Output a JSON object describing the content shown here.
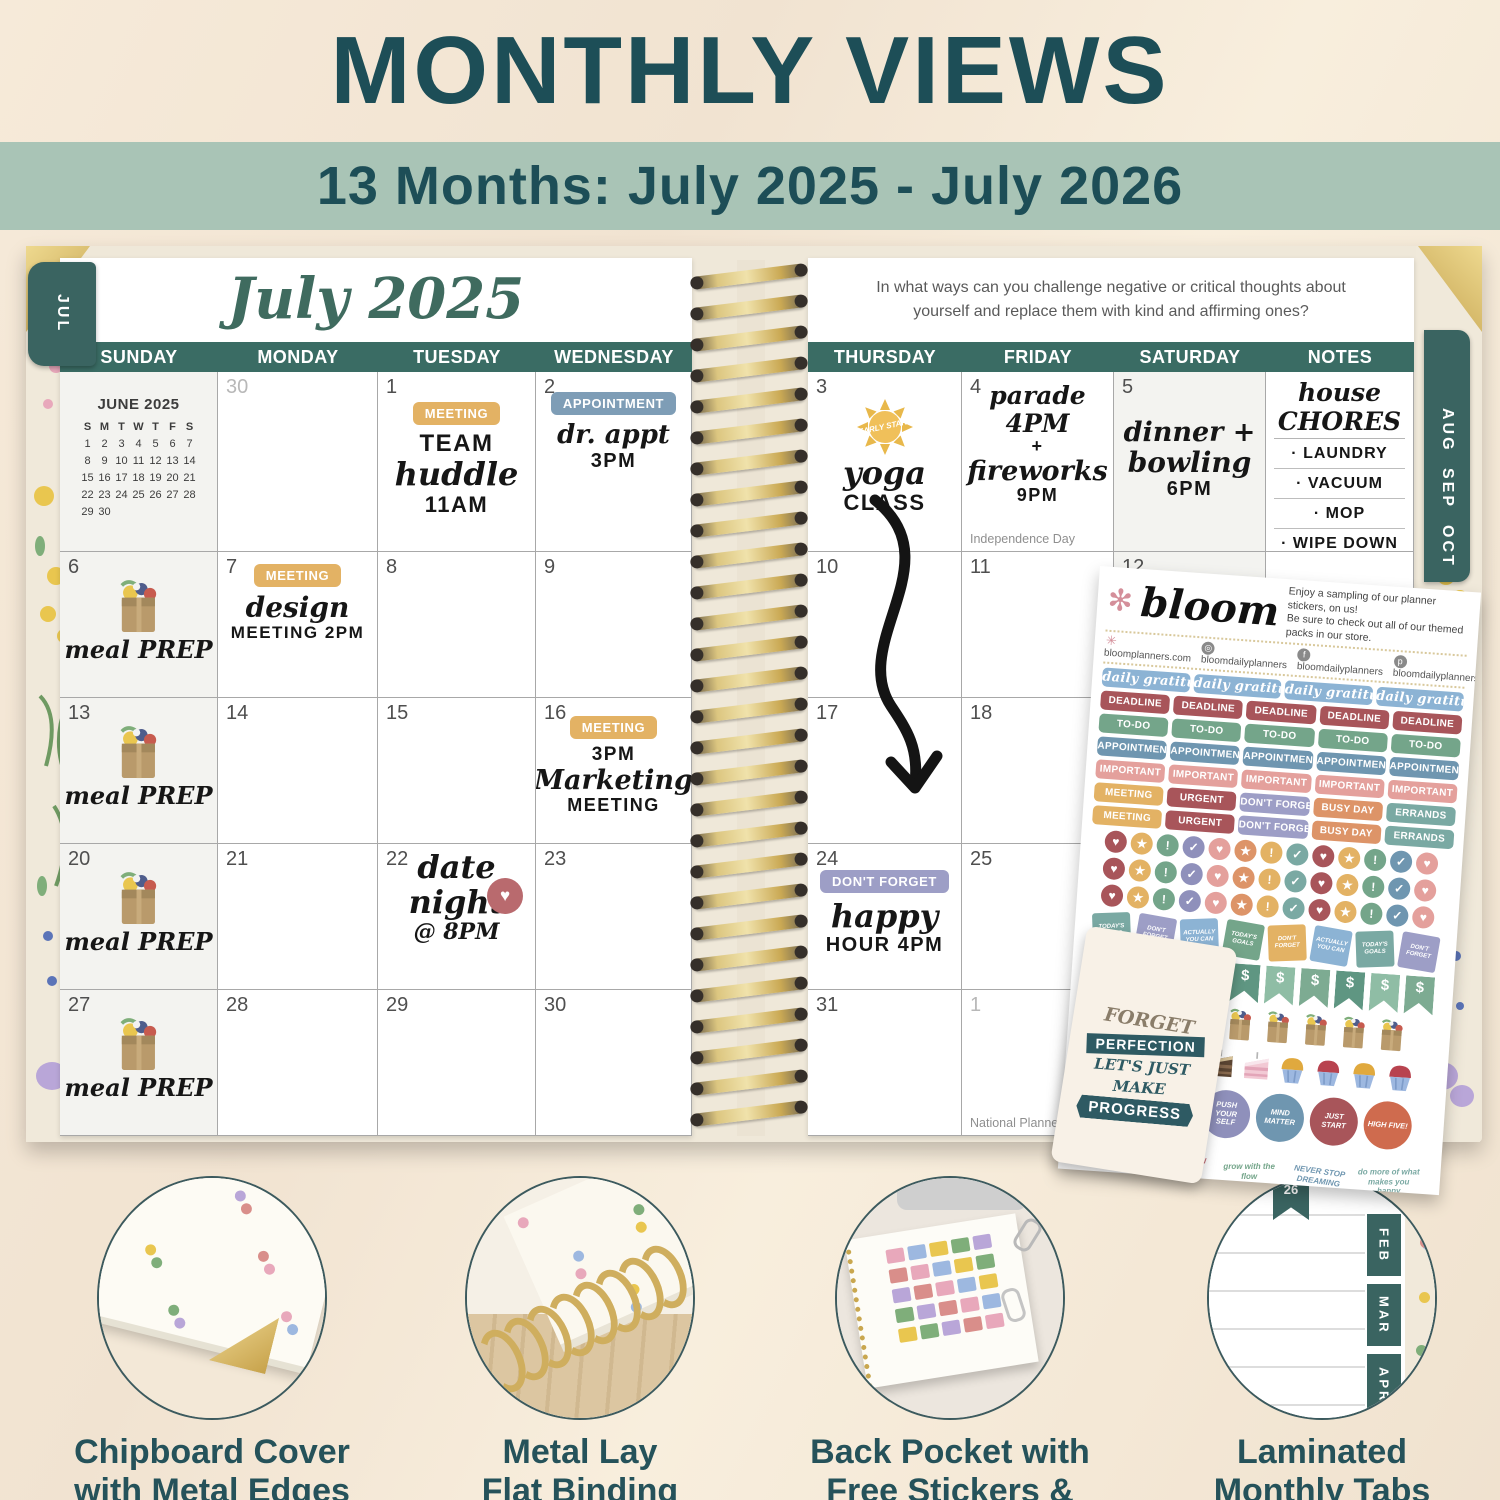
{
  "palette": {
    "title_teal": "#1d4e57",
    "band_sage": "#a9c4b6",
    "calendar_header_teal": "#3a6c64",
    "tab_teal": "#3a6461",
    "gold": "#d6b96a",
    "page_white": "#ffffff"
  },
  "header": {
    "title": "MONTHLY VIEWS",
    "subtitle": "13 Months: July 2025 - July 2026"
  },
  "left_page": {
    "tab": "JUL",
    "month_title": "July 2025",
    "day_headers": [
      "SUNDAY",
      "MONDAY",
      "TUESDAY",
      "WEDNESDAY"
    ],
    "mini_calendar": {
      "title": "JUNE 2025",
      "dow": [
        "S",
        "M",
        "T",
        "W",
        "T",
        "F",
        "S"
      ],
      "weeks": [
        [
          "1",
          "2",
          "3",
          "4",
          "5",
          "6",
          "7"
        ],
        [
          "8",
          "9",
          "10",
          "11",
          "12",
          "13",
          "14"
        ],
        [
          "15",
          "16",
          "17",
          "18",
          "19",
          "20",
          "21"
        ],
        [
          "22",
          "23",
          "24",
          "25",
          "26",
          "27",
          "28"
        ],
        [
          "29",
          "30",
          "",
          "",
          "",
          "",
          ""
        ]
      ]
    },
    "rows": [
      {
        "cells": [
          {
            "type": "minical"
          },
          {
            "day": "30",
            "muted": true
          },
          {
            "day": "1",
            "sticker": {
              "label": "MEETING",
              "color": "#e3b264"
            },
            "hand": [
              {
                "t": "TEAM",
                "s": "hc",
                "z": 24
              },
              {
                "t": "huddle",
                "s": "hs",
                "z": 32
              },
              {
                "t": "11AM",
                "s": "hc",
                "z": 22
              }
            ]
          },
          {
            "day": "2",
            "gap": 16,
            "sticker": {
              "label": "APPOINTMENT",
              "color": "#7e9db6"
            },
            "hand": [
              {
                "t": "dr. appt",
                "s": "hs",
                "z": 26
              },
              {
                "t": "3PM",
                "s": "hc",
                "z": 20
              }
            ]
          }
        ]
      },
      {
        "cells": [
          {
            "day": "6",
            "icon": "bag",
            "hand": [
              {
                "t": "meal PREP",
                "s": "hs",
                "z": 24
              }
            ]
          },
          {
            "day": "7",
            "gap": 8,
            "sticker": {
              "label": "MEETING",
              "color": "#e3b264"
            },
            "hand": [
              {
                "t": "design",
                "s": "hs",
                "z": 28
              },
              {
                "t": "MEETING 2PM",
                "s": "hc",
                "z": 17
              }
            ]
          },
          {
            "day": "8"
          },
          {
            "day": "9"
          }
        ]
      },
      {
        "cells": [
          {
            "day": "13",
            "icon": "bag",
            "hand": [
              {
                "t": "meal PREP",
                "s": "hs",
                "z": 24
              }
            ]
          },
          {
            "day": "14"
          },
          {
            "day": "15"
          },
          {
            "day": "16",
            "gap": 14,
            "sticker": {
              "label": "MEETING",
              "color": "#e3b264"
            },
            "hand": [
              {
                "t": "3PM",
                "s": "hc",
                "z": 19
              },
              {
                "t": "Marketing",
                "s": "hs",
                "z": 27
              },
              {
                "t": "MEETING",
                "s": "hc",
                "z": 18
              }
            ]
          }
        ]
      },
      {
        "cells": [
          {
            "day": "20",
            "icon": "bag",
            "hand": [
              {
                "t": "meal PREP",
                "s": "hs",
                "z": 24
              }
            ]
          },
          {
            "day": "21"
          },
          {
            "day": "22",
            "gap": 6,
            "icon": "heart",
            "hand": [
              {
                "t": "date",
                "s": "hs",
                "z": 32
              },
              {
                "t": "night",
                "s": "hs",
                "z": 32
              },
              {
                "t": "@ 8PM",
                "s": "hs",
                "z": 22
              }
            ]
          },
          {
            "day": "23"
          }
        ]
      },
      {
        "cells": [
          {
            "day": "27",
            "icon": "bag",
            "hand": [
              {
                "t": "meal PREP",
                "s": "hs",
                "z": 24
              }
            ]
          },
          {
            "day": "28"
          },
          {
            "day": "29"
          },
          {
            "day": "30"
          }
        ]
      }
    ]
  },
  "right_page": {
    "prompt_line1": "In what ways can you challenge negative or critical thoughts about",
    "prompt_line2": "yourself and replace them with kind and affirming ones?",
    "day_headers": [
      "THURSDAY",
      "FRIDAY",
      "SATURDAY",
      "NOTES"
    ],
    "tabs": [
      "AUG",
      "SEP",
      "OCT"
    ],
    "notes": {
      "heading": "house CHORES",
      "items": [
        "· LAUNDRY",
        "· VACUUM",
        "· MOP",
        "· WIPE DOWN",
        "KITCHEN"
      ]
    },
    "rows": [
      {
        "cells": [
          {
            "day": "3",
            "icon": "sun",
            "icon_label": "EARLY START",
            "hand": [
              {
                "t": "yoga",
                "s": "hs",
                "z": 32
              },
              {
                "t": "CLASS",
                "s": "hc",
                "z": 22
              }
            ]
          },
          {
            "day": "4",
            "gap": 10,
            "hand": [
              {
                "t": "parade 4PM",
                "s": "hs",
                "z": 25
              },
              {
                "t": "+",
                "s": "hc",
                "z": 18
              },
              {
                "t": "fireworks",
                "s": "hs",
                "z": 27
              },
              {
                "t": "9PM",
                "s": "hc",
                "z": 18
              }
            ],
            "note": "Independence Day"
          },
          {
            "day": "5",
            "gap": 46,
            "shaded": true,
            "hand": [
              {
                "t": "dinner +",
                "s": "hs",
                "z": 27
              },
              {
                "t": "bowling",
                "s": "hs",
                "z": 28
              },
              {
                "t": "6PM",
                "s": "hc",
                "z": 20
              }
            ]
          },
          {
            "type": "notes"
          }
        ]
      },
      {
        "cells": [
          {
            "day": "10"
          },
          {
            "day": "11"
          },
          {
            "day": "12",
            "shaded": true
          },
          {
            "type": "ruled"
          }
        ]
      },
      {
        "cells": [
          {
            "day": "17"
          },
          {
            "day": "18"
          },
          {
            "shaded": true
          },
          {
            "type": "ruled"
          }
        ]
      },
      {
        "cells": [
          {
            "day": "24",
            "gap": 22,
            "sticker": {
              "label": "DON'T FORGET",
              "color": "#9d9ec6"
            },
            "hand": [
              {
                "t": "happy",
                "s": "hs",
                "z": 32
              },
              {
                "t": "HOUR 4PM",
                "s": "hc",
                "z": 20
              }
            ]
          },
          {
            "day": "25"
          },
          {
            "shaded": true
          },
          {
            "type": "ruled"
          }
        ]
      },
      {
        "cells": [
          {
            "day": "31"
          },
          {
            "day": "1",
            "muted": true,
            "note": "National Planner Day"
          },
          {
            "shaded": true
          },
          {
            "type": "ruled"
          }
        ]
      }
    ]
  },
  "sticker_sheet": {
    "brand": "bloom",
    "tagline": [
      "Enjoy a sampling of our planner stickers, on us!",
      "Be sure to check out all of our themed packs in our store."
    ],
    "links": [
      {
        "icon": "flower",
        "text": "bloomplanners.com"
      },
      {
        "icon": "instagram",
        "text": "bloomdailyplanners"
      },
      {
        "icon": "facebook",
        "text": "bloomdailyplanners"
      },
      {
        "icon": "pinterest",
        "text": "bloomdailyplanners"
      }
    ],
    "pill_rows": [
      {
        "script": true,
        "color": "#8cb3d4",
        "labels": [
          "daily gratitude",
          "daily gratitude",
          "daily gratitude",
          "daily gratitude"
        ]
      },
      {
        "color": "#a8555a",
        "labels": [
          "DEADLINE",
          "DEADLINE",
          "DEADLINE",
          "DEADLINE",
          "DEADLINE"
        ]
      },
      {
        "color": "#74a58a",
        "labels": [
          "TO-DO",
          "TO-DO",
          "TO-DO",
          "TO-DO",
          "TO-DO"
        ]
      },
      {
        "color": "#6f96b0",
        "labels": [
          "APPOINTMENT",
          "APPOINTMENT",
          "APPOINTMENT",
          "APPOINTMENT",
          "APPOINTMENT"
        ]
      },
      {
        "color": "#e4a09c",
        "labels": [
          "IMPORTANT",
          "IMPORTANT",
          "IMPORTANT",
          "IMPORTANT",
          "IMPORTANT"
        ]
      },
      {
        "colors": [
          "#e3b264",
          "#a8555a",
          "#9d9ec6",
          "#dd9468",
          "#7aa9a3"
        ],
        "labels": [
          "MEETING",
          "URGENT",
          "DON'T FORGET",
          "BUSY DAY",
          "ERRANDS"
        ]
      },
      {
        "colors": [
          "#e3b264",
          "#a8555a",
          "#9d9ec6",
          "#dd9468",
          "#7aa9a3"
        ],
        "labels": [
          "MEETING",
          "URGENT",
          "DON'T FORGET",
          "BUSY DAY",
          "ERRANDS"
        ]
      }
    ],
    "circle_pattern": [
      {
        "icon": "heart",
        "color": "#a8555a"
      },
      {
        "icon": "star",
        "color": "#e3b264"
      },
      {
        "icon": "exclaim",
        "color": "#74a58a"
      },
      {
        "icon": "check",
        "color": "#8f90bb"
      },
      {
        "icon": "heart",
        "color": "#e4a09c"
      },
      {
        "icon": "star",
        "color": "#dd9468"
      },
      {
        "icon": "exclaim",
        "color": "#e3b264"
      },
      {
        "icon": "check",
        "color": "#7aa9a3"
      },
      {
        "icon": "heart",
        "color": "#a8555a"
      },
      {
        "icon": "star",
        "color": "#e3b264"
      },
      {
        "icon": "exclaim",
        "color": "#74a58a"
      },
      {
        "icon": "check",
        "color": "#6f96b0"
      },
      {
        "icon": "heart",
        "color": "#e4a09c"
      }
    ],
    "circle_rows": 3,
    "sticky_notes": [
      {
        "label": "TODAY'S GOALS",
        "color": "#7aa9a3"
      },
      {
        "label": "DON'T FORGET",
        "color": "#9d9ec6"
      },
      {
        "label": "ACTUALLY YOU CAN",
        "color": "#8cb3d4"
      },
      {
        "label": "TODAY'S GOALS",
        "color": "#74a58a"
      },
      {
        "label": "DON'T FORGET",
        "color": "#e3b264"
      },
      {
        "label": "ACTUALLY YOU CAN",
        "color": "#8cb3d4"
      },
      {
        "label": "TODAY'S GOALS",
        "color": "#7aa9a3"
      },
      {
        "label": "DON'T FORGET",
        "color": "#9d9ec6"
      }
    ],
    "flag_symbol": "$",
    "flag_count": 10,
    "bag_count": 8,
    "treats": [
      "cake-pink",
      "cake-choc",
      "cake-pink",
      "cake-choc",
      "cake-pink",
      "cupcake-gold",
      "cupcake-red",
      "cupcake-gold",
      "cupcake-red"
    ],
    "round_stickers": [
      {
        "type": "sun",
        "label": "EARLY START"
      },
      {
        "type": "scene",
        "label": ""
      },
      {
        "label": "PUSH YOUR SELF",
        "color": "#8f90bb"
      },
      {
        "label": "MIND MATTER",
        "color": "#6f96b0"
      },
      {
        "label": "JUST START",
        "color": "#a8555a"
      },
      {
        "label": "HIGH FIVE!",
        "color": "#cf6b4e"
      }
    ],
    "word_art": [
      {
        "text": "be proud of you",
        "color": "#8f90bb"
      },
      {
        "text": "FORGET PERFECTION LET'S JUST MAKE PROGRESS",
        "color": "#c46a72"
      },
      {
        "text": "grow with the flow",
        "color": "#74a58a"
      },
      {
        "text": "NEVER STOP DREAMING",
        "color": "#6f96b0"
      },
      {
        "text": "do more of what makes you happy",
        "color": "#7aa9a3"
      }
    ]
  },
  "bookmark": {
    "lines": [
      "FORGET",
      "PERFECTION",
      "LET'S JUST",
      "MAKE",
      "PROGRESS"
    ]
  },
  "features": [
    {
      "line1": "Chipboard Cover",
      "line2": "with Metal Edges"
    },
    {
      "line1": "Metal Lay",
      "line2": "Flat Binding"
    },
    {
      "line1": "Back Pocket with",
      "line2": "Free Stickers & Bookmark"
    },
    {
      "line1": "Laminated",
      "line2": "Monthly Tabs",
      "tabs": [
        "FEB",
        "MAR",
        "APR"
      ],
      "ribbon": "26"
    }
  ]
}
